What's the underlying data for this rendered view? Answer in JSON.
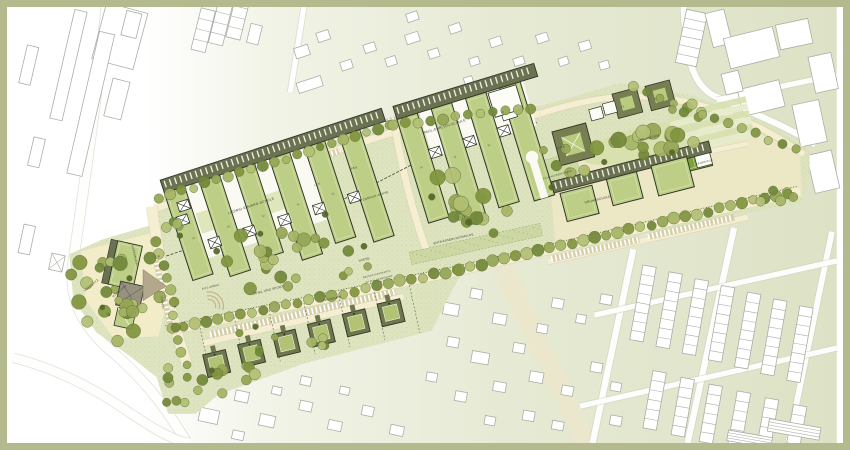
{
  "palette": {
    "frame": "#b4b98e",
    "wash_light": "#f1f3e6",
    "wash": "#dde2c6",
    "lawn": "#dce3bd",
    "path_cream": "#f4ecca",
    "promenade": "#f3e9c2",
    "roof_green": "#bdcf86",
    "band_dark": "#6b7252",
    "ring_dark": "#767e52",
    "court_green": "#b9cc7e",
    "pitch": "#7da23c",
    "tree_main": "#95a656",
    "tree_dark": "#55662c",
    "outline": "#2e3226",
    "context_line": "#a9ada4",
    "text": "#3a3e30"
  },
  "labels": [
    {
      "id": "vorplatz",
      "text": "VORPLATZ"
    },
    {
      "id": "supermarkt",
      "text": "SUPERMARKT"
    },
    {
      "id": "wohnturm",
      "text": "WOHNTURM"
    },
    {
      "id": "p-north",
      "text": "P"
    },
    {
      "id": "p-south",
      "text": "P"
    },
    {
      "id": "ludwig-erhard-schule",
      "text": "LUDWIG-ERHARD-SCHULE"
    },
    {
      "id": "paul-ehrlich-schule",
      "text": "PAUL-EHRLICH-SCHULE"
    },
    {
      "id": "les",
      "text": "LES"
    },
    {
      "id": "pes",
      "text": "PES"
    },
    {
      "id": "campus-achse",
      "text": "CAMPUS-ACHSE"
    },
    {
      "id": "kita",
      "text": "KITA"
    },
    {
      "id": "kiga-aussenflaeche",
      "text": "KIGA-AUSSENFLÄCHE"
    },
    {
      "id": "arboretum",
      "text": "ARBORETUM"
    },
    {
      "id": "grundschule",
      "text": "GRUNDSCHULE"
    },
    {
      "id": "sportfeld",
      "text": "SPORTFELD"
    },
    {
      "id": "wiese",
      "text": "WIESE"
    },
    {
      "id": "spiel-und-sport",
      "text": "SPIEL UND SPORT"
    },
    {
      "id": "sitz-arena",
      "text": "SITZ-ARENA"
    },
    {
      "id": "entwaesserungsmulde",
      "text": "ENTWÄSSERUNGSMULDE"
    },
    {
      "id": "grundstueckskante",
      "text": "GRUNDSTÜCKSKANTE:"
    },
    {
      "id": "sitzen-begruenung",
      "text": "SITZEN, BEGRÜNUNG"
    },
    {
      "id": "promenade",
      "text": "PROMENADE"
    },
    {
      "id": "strasse",
      "text": "STRASSE"
    },
    {
      "id": "lud-num-1",
      "text": "IV"
    },
    {
      "id": "lud-num-2",
      "text": "III"
    },
    {
      "id": "lud-num-3",
      "text": "IV"
    },
    {
      "id": "lud-num-4",
      "text": "IV"
    },
    {
      "id": "lud-num-5",
      "text": "III"
    },
    {
      "id": "paul-num-1",
      "text": "IV"
    },
    {
      "id": "paul-num-2",
      "text": "IV"
    },
    {
      "id": "paul-num-3",
      "text": "III"
    },
    {
      "id": "mensa-num",
      "text": "III"
    },
    {
      "id": "hof-num-1",
      "text": "IV"
    },
    {
      "id": "hof-num-2",
      "text": "IV"
    }
  ]
}
